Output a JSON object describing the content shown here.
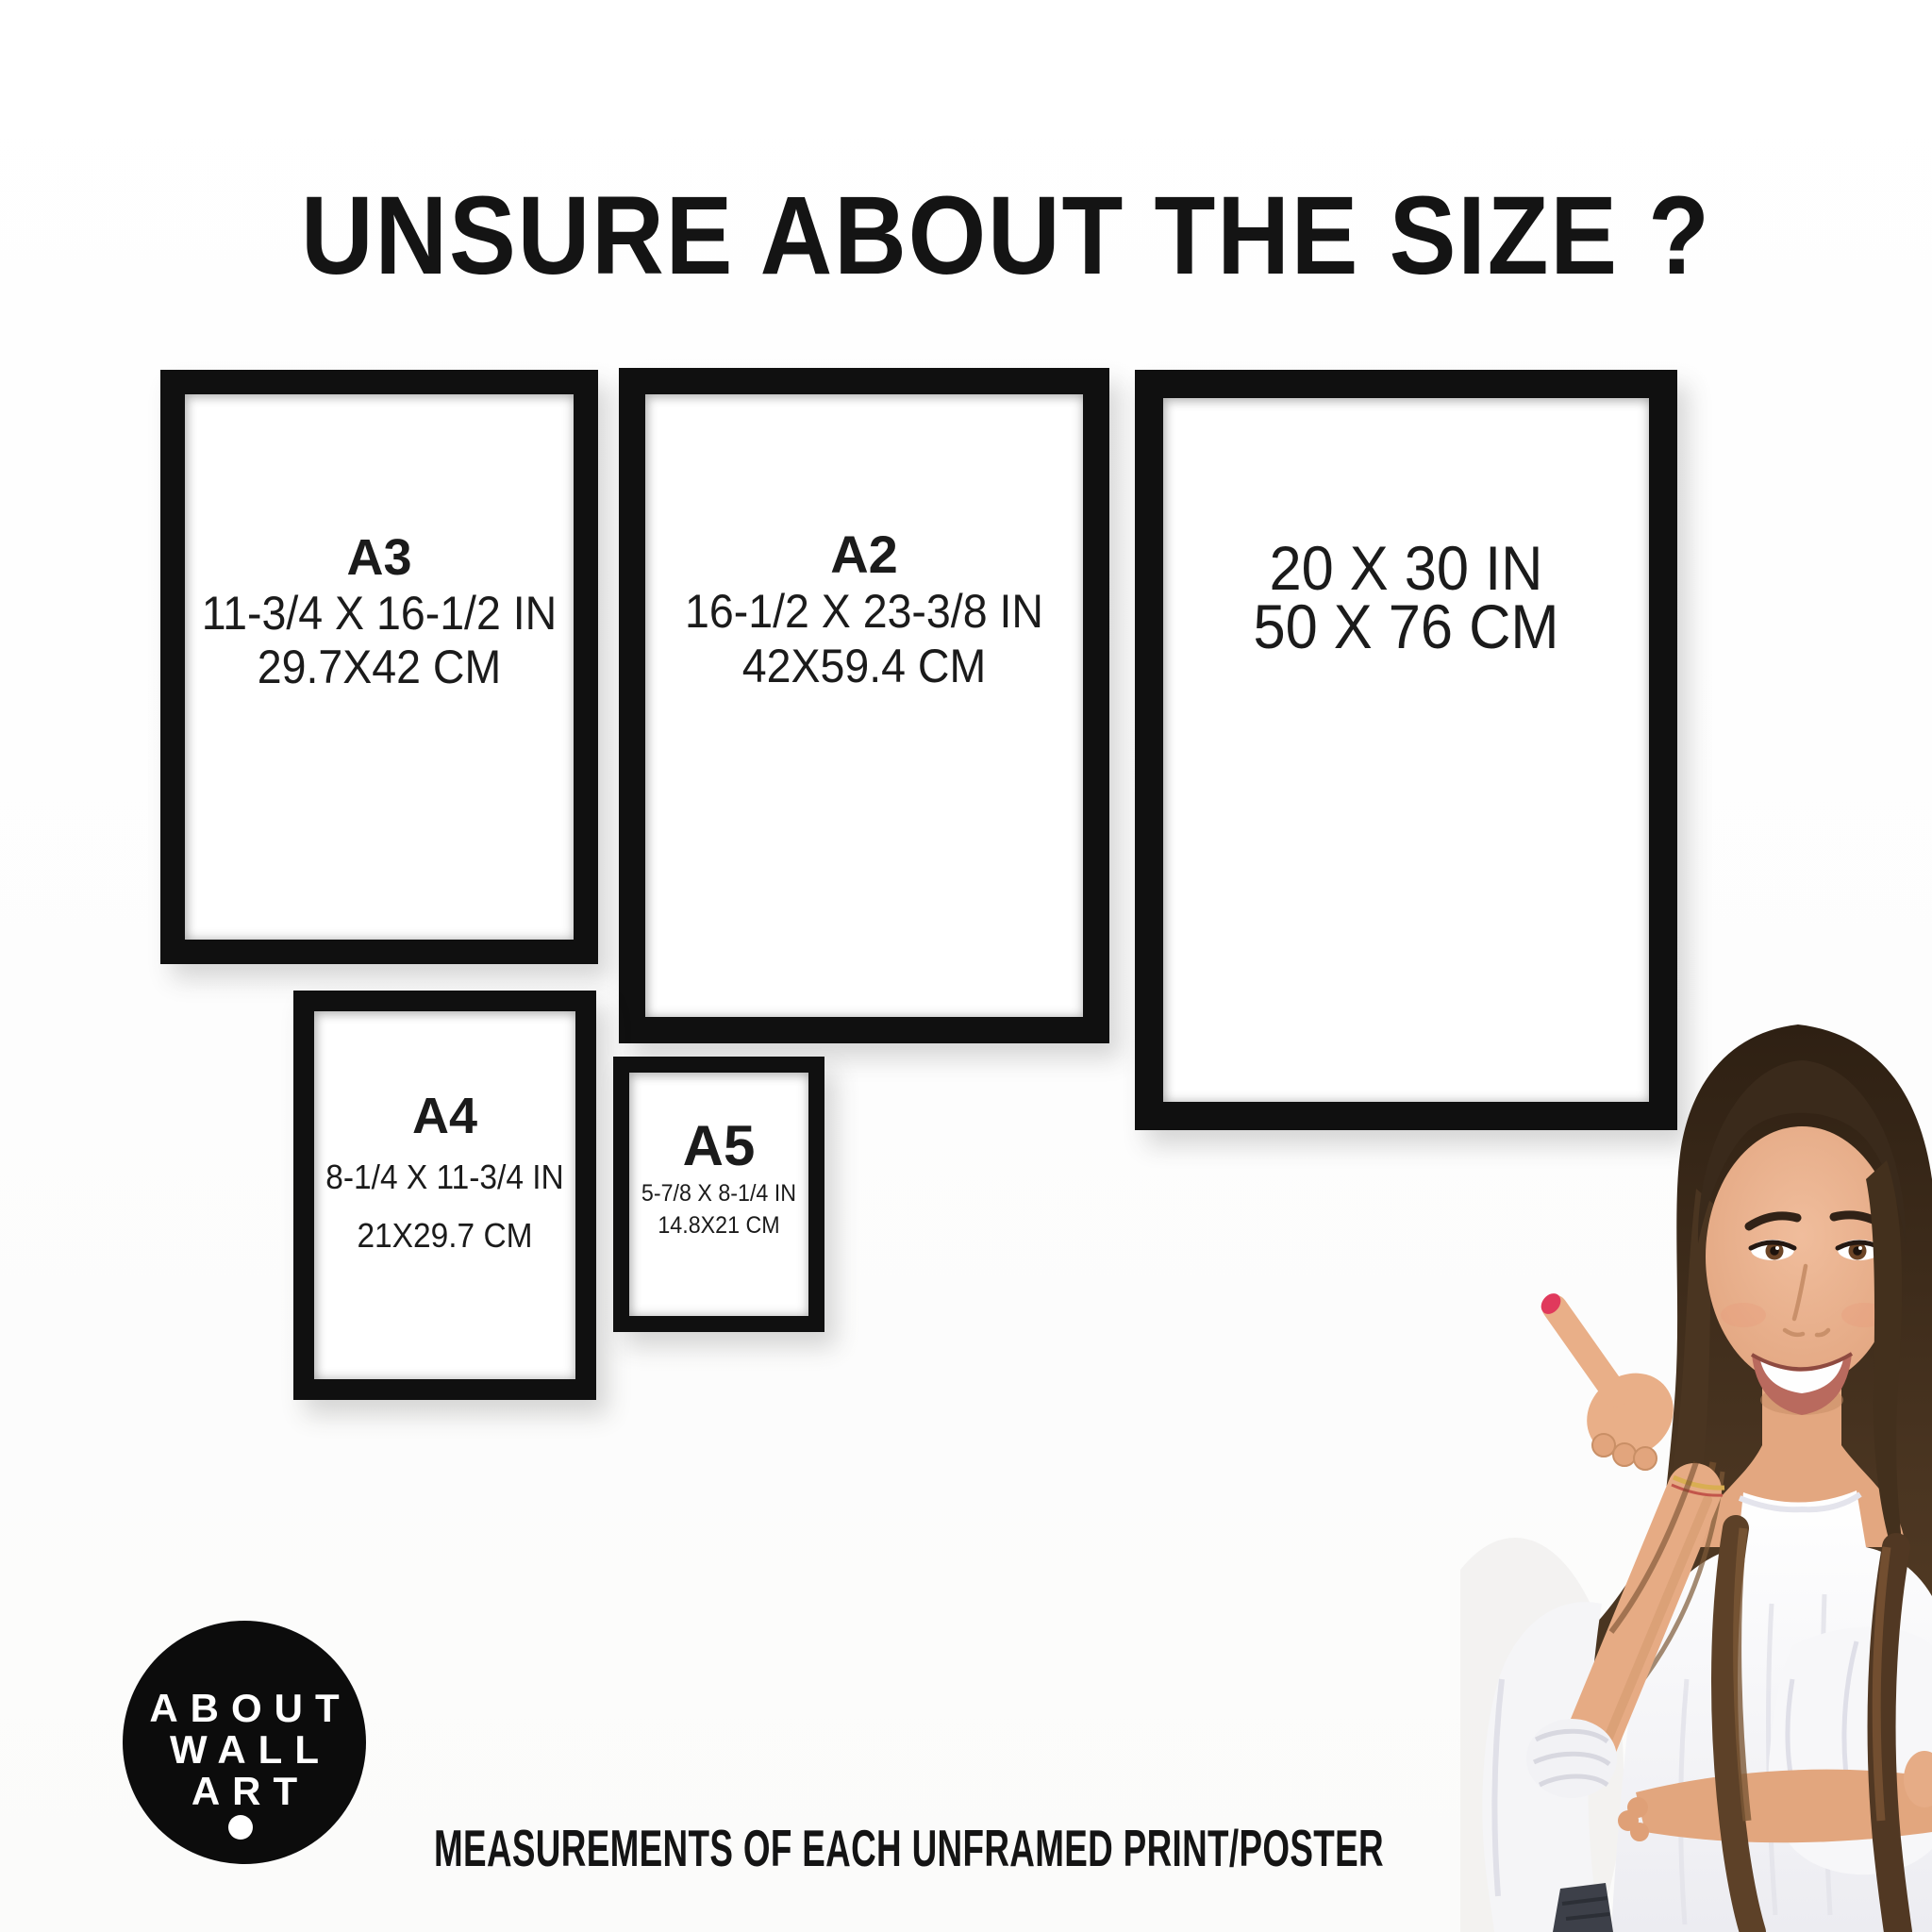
{
  "header": {
    "title": "UNSURE ABOUT THE SIZE ?"
  },
  "frames": [
    {
      "name": "A3",
      "inches": "11-3/4 X 16-1/2 IN",
      "cm": "29.7X42 CM"
    },
    {
      "name": "A2",
      "inches": "16-1/2 X 23-3/8 IN",
      "cm": "42X59.4 CM"
    },
    {
      "name": "",
      "inches": "20 X 30 IN",
      "cm": "50 X 76 CM"
    },
    {
      "name": "A4",
      "inches": "8-1/4 X 11-3/4 IN",
      "cm": "21X29.7 CM"
    },
    {
      "name": "A5",
      "inches": "5-7/8 X 8-1/4 IN",
      "cm": "14.8X21 CM"
    }
  ],
  "logo": {
    "lines": [
      "ABOUT",
      "WALL",
      "ART"
    ]
  },
  "footer": {
    "caption": "MEASUREMENTS OF EACH UNFRAMED PRINT/POSTER"
  },
  "photo": {
    "subject": "Smiling woman with long brown hair pointing at the size chart"
  },
  "colors": {
    "frame_black": "#101010",
    "text": "#161616",
    "logo_background": "#0c0c0c",
    "logo_text": "#ffffff",
    "nail_red": "#e0395c",
    "hair_brown": "#4a3521",
    "skin": "#e6ab84",
    "blouse_white": "#f6f6f8",
    "jeans_dark": "#3d4049",
    "background": "#ffffff"
  }
}
